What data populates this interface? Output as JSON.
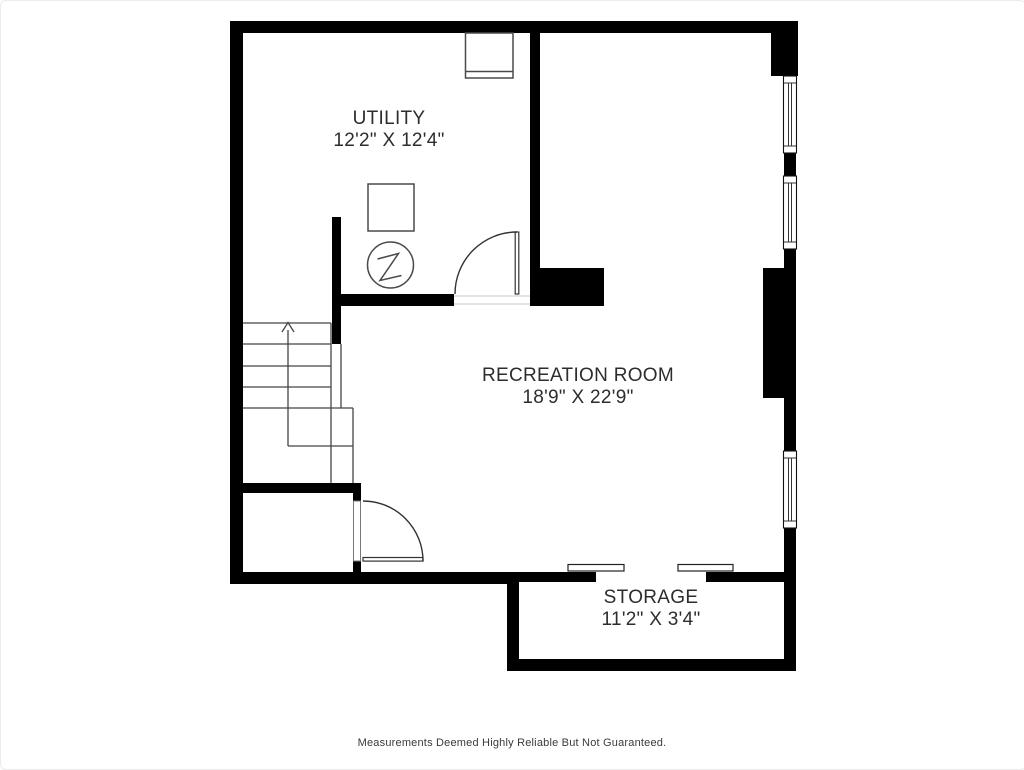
{
  "plan": {
    "title": "basement-floor-plan",
    "rooms": [
      {
        "id": "utility",
        "name": "UTILITY",
        "dimensions": "12'2\" X 12'4\""
      },
      {
        "id": "recreation",
        "name": "RECREATION ROOM",
        "dimensions": "18'9\" X 22'9\""
      },
      {
        "id": "storage",
        "name": "STORAGE",
        "dimensions": "11'2\" X 3'4\""
      }
    ],
    "disclaimer": "Measurements Deemed Highly Reliable But Not Guaranteed.",
    "fixtures": [
      "laundry-sink",
      "water-heater",
      "electrical-panel",
      "staircase-up",
      "hinged-door-utility",
      "hinged-door-recreation",
      "sliding-bypass-door-storage",
      "window-right-upper",
      "window-right-middle",
      "window-right-lower",
      "chimney-bump"
    ],
    "colors": {
      "wall": "#000000",
      "fixture_line": "#4a4a4a",
      "door_line": "#333333",
      "stair_line": "#454545",
      "window_frame": "#111111",
      "text": "#2d2d2d",
      "background": "#ffffff"
    }
  }
}
